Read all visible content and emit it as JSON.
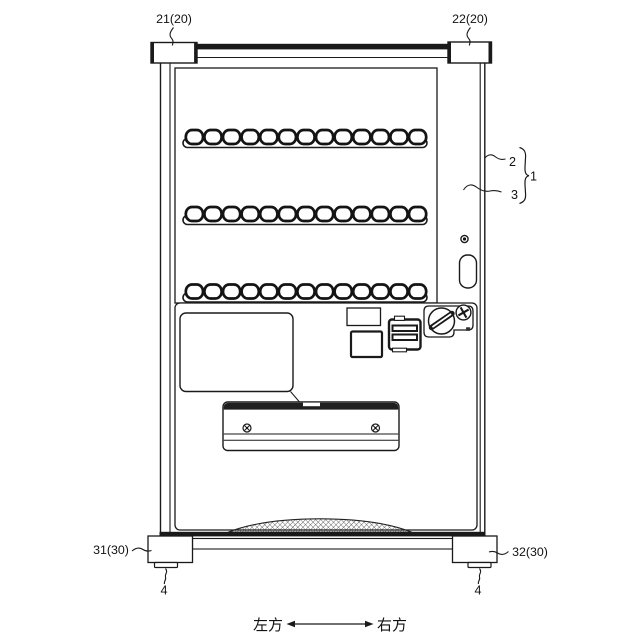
{
  "figure_labels": {
    "bracket_left": "21(20)",
    "bracket_right": "22(20)",
    "outer_door_panel": "2",
    "inner_door_panel": "3",
    "machine_body": "1",
    "leg_left": "31(30)",
    "leg_right": "32(30)",
    "foot_left": "4",
    "foot_right": "4"
  },
  "direction_indicator": {
    "left_label": "左方",
    "right_label": "右方"
  },
  "shelves": {
    "rows": 3,
    "cells_per_row": 13
  },
  "colors": {
    "line": "#1a1a1a",
    "background": "#ffffff"
  }
}
